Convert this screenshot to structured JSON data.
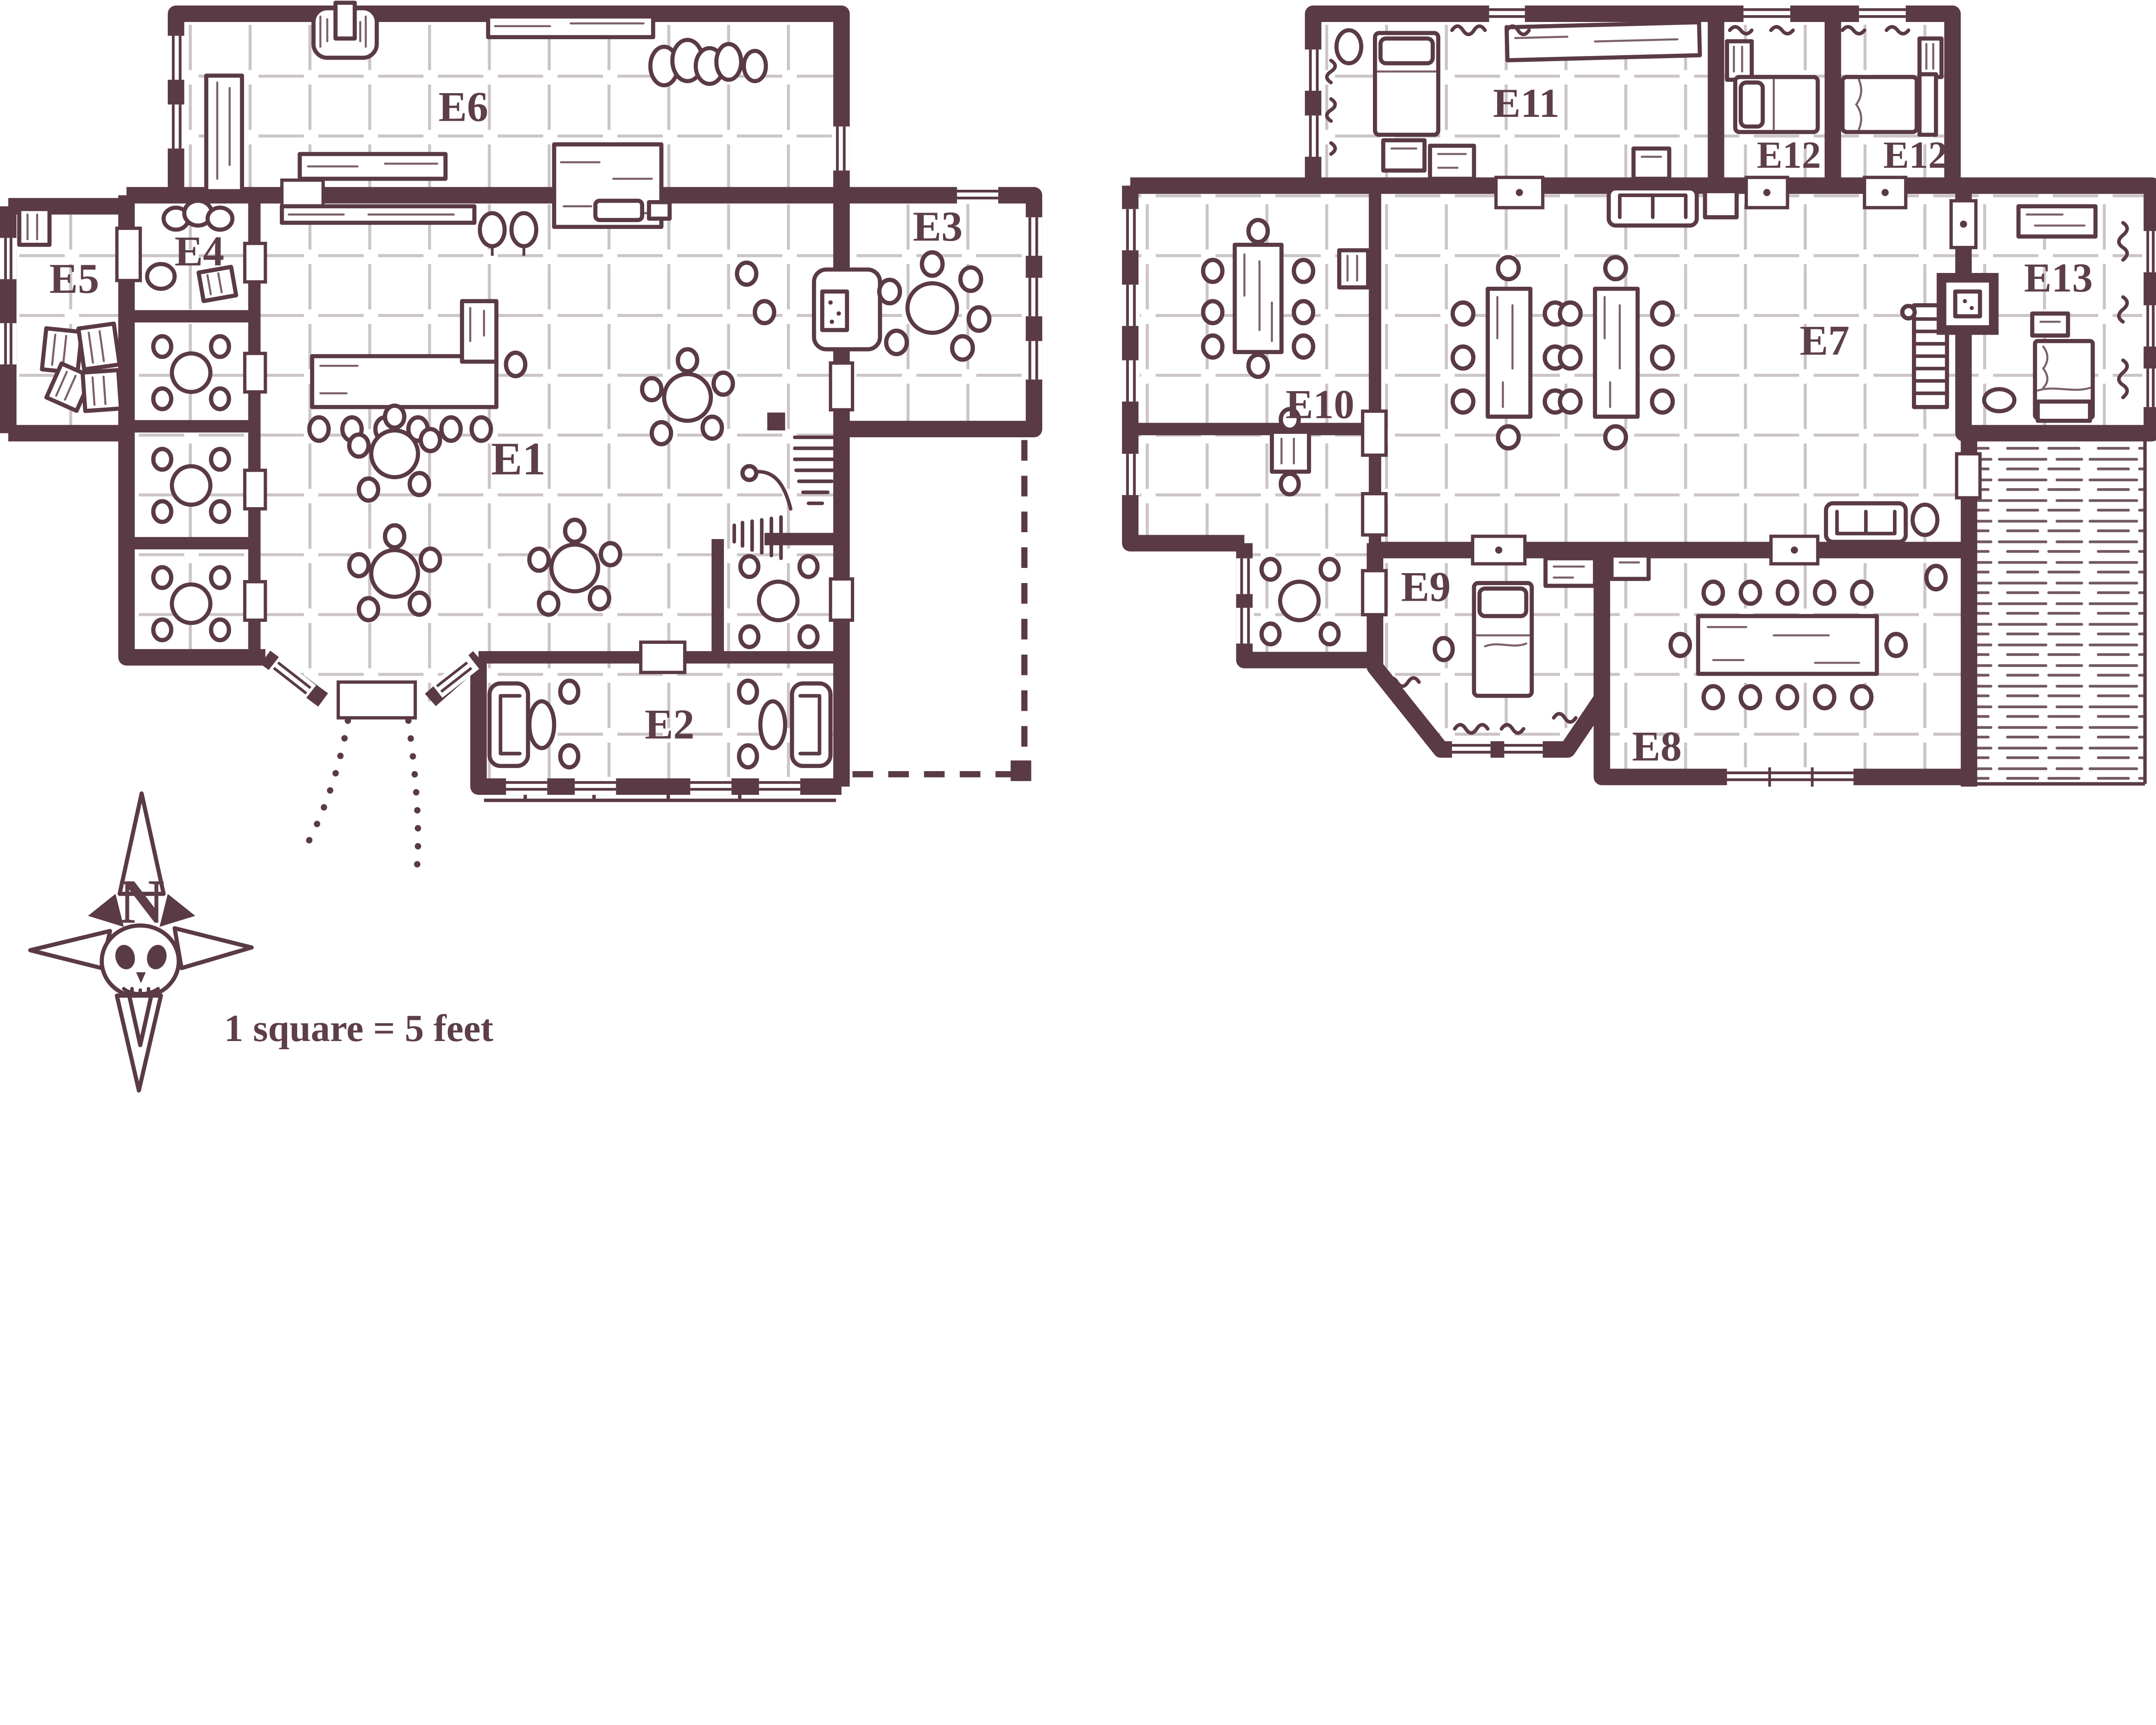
{
  "map": {
    "type": "floorplan",
    "scale_note": "1 square = 5 feet",
    "compass": {
      "letter": "N"
    },
    "colors": {
      "wall": "#5a3a45",
      "grid": "#ccc5c7",
      "paper": "#ffffff",
      "label": "#5d3e49"
    },
    "labels": {
      "e1": "E1",
      "e2": "E2",
      "e3": "E3",
      "e4": "E4",
      "e5": "E5",
      "e6": "E6",
      "e7": "E7",
      "e8": "E8",
      "e9": "E9",
      "e10": "E10",
      "e11": "E11",
      "e12a": "E12",
      "e12b": "E12",
      "e13": "E13"
    },
    "rooms": [
      {
        "id": "E1",
        "note": "common hall: L-shaped bar, stools, round tables, hearth, stairs"
      },
      {
        "id": "E2",
        "note": "lounge: two armchairs, oval tables, stools, veranda windows"
      },
      {
        "id": "E3",
        "note": "dining room: round table with six stools"
      },
      {
        "id": "E4",
        "note": "pantry: sacks and crate"
      },
      {
        "id": "E5",
        "note": "storeroom: crates"
      },
      {
        "id": "E6",
        "note": "kitchen/brewery: forge, tables, shelf, sacks"
      },
      {
        "id": "E7",
        "note": "upper hall: two long tables with stools, sofas, shelf-ladder, fireplace"
      },
      {
        "id": "E8",
        "note": "feast room: long table with twelve seats"
      },
      {
        "id": "E9",
        "note": "bay bedroom: bed, dresser, stool"
      },
      {
        "id": "E10",
        "note": "dining room: long table with eight seats"
      },
      {
        "id": "E11",
        "note": "bedroom: bed, chests, long table"
      },
      {
        "id": "E12a",
        "note": "small bedroom: bed, crate"
      },
      {
        "id": "E12b",
        "note": "small bedroom: bed, crate"
      },
      {
        "id": "E13",
        "note": "bedroom: bed, dresser, nightstand, rug"
      }
    ]
  }
}
